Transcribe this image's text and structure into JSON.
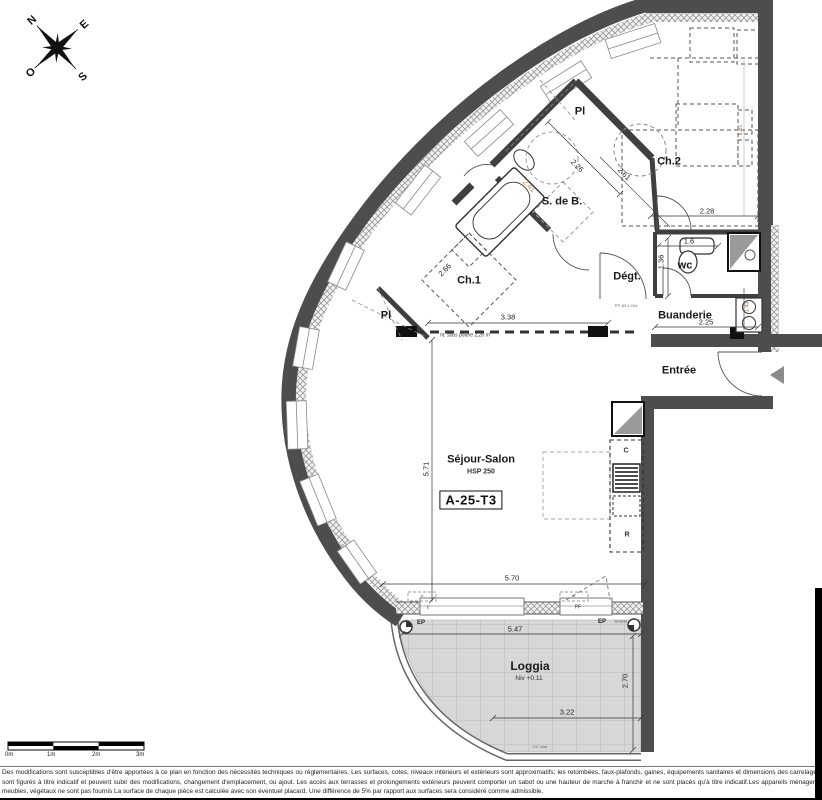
{
  "plan": {
    "code": "A-25-T3"
  },
  "compass": {
    "n": "N",
    "e": "E",
    "s": "S",
    "o": "O"
  },
  "rooms": {
    "pl_top": "Pl",
    "pl_left": "Pl",
    "ch1": "Ch.1",
    "ch2": "Ch.2",
    "sdb": "S. de B.",
    "degt": "Dégt.",
    "wc": "wc",
    "buanderie": "Buanderie",
    "entree": "Entrée",
    "sejour": "Séjour-Salon",
    "sejour_sub": "HSP 250",
    "loggia": "Loggia",
    "loggia_sub": "Niv +0.11"
  },
  "dimensions": {
    "ch2_width": "2.28",
    "wc_width": "1.6",
    "wc_depth": "1.36",
    "ch2_side": "1.61",
    "buanderie_width": "2.25",
    "buanderie_depth": "1.43",
    "ch1_width": "3.38",
    "ch1_diag": "2.66",
    "sdb_diag": "2.26",
    "degt_diag": "2.61",
    "sdb_diag2": "2.41",
    "sejour_depth": "5.71",
    "sejour_width": "5.70",
    "loggia_width": "5.47",
    "loggia_inner": "3.22",
    "loggia_depth": "2.70"
  },
  "annotations": {
    "beam_note": "ht. sous poutre 2,20 m",
    "door_note": "PP. 83 x 204",
    "ep1": "EP",
    "ep2": "EP",
    "terrasse": "terrasse",
    "vr1": "vr",
    "vr2": "vr",
    "window_c": "c",
    "window_pf": "PF",
    "kitchen_c": "C",
    "kitchen_r": "R",
    "railing": "GC vitré"
  },
  "scalebar": {
    "labels": [
      "0m",
      "1m",
      "2m",
      "3m"
    ]
  },
  "disclaimer": "Des modifications sont susceptibles d'être apportées à ce plan en fonction des nécessités techniques ou réglementaires. Les surfaces, cotes, niveaux intérieurs et extérieurs sont approximatifs; les retombées, faux-plafonds, gaines, équipements sanitaires et dimensions des carrelages sont figurés à titre indicatif et peuvent subir des modifications, changement d'emplacement, ou ajout. Les accès aux terrasses et prolongements extérieurs peuvent comporter un sabot ou une hauteur de marche à franchir et ne sont placés qu'à titre indicatif.Les appareils ménagers, meubles, végétaux ne sont pas fournis La surface de chaque pièce est calculée avec son éventuel placard. Une différence de 5% par rapport aux surfaces sera considéré comme admissible."
}
